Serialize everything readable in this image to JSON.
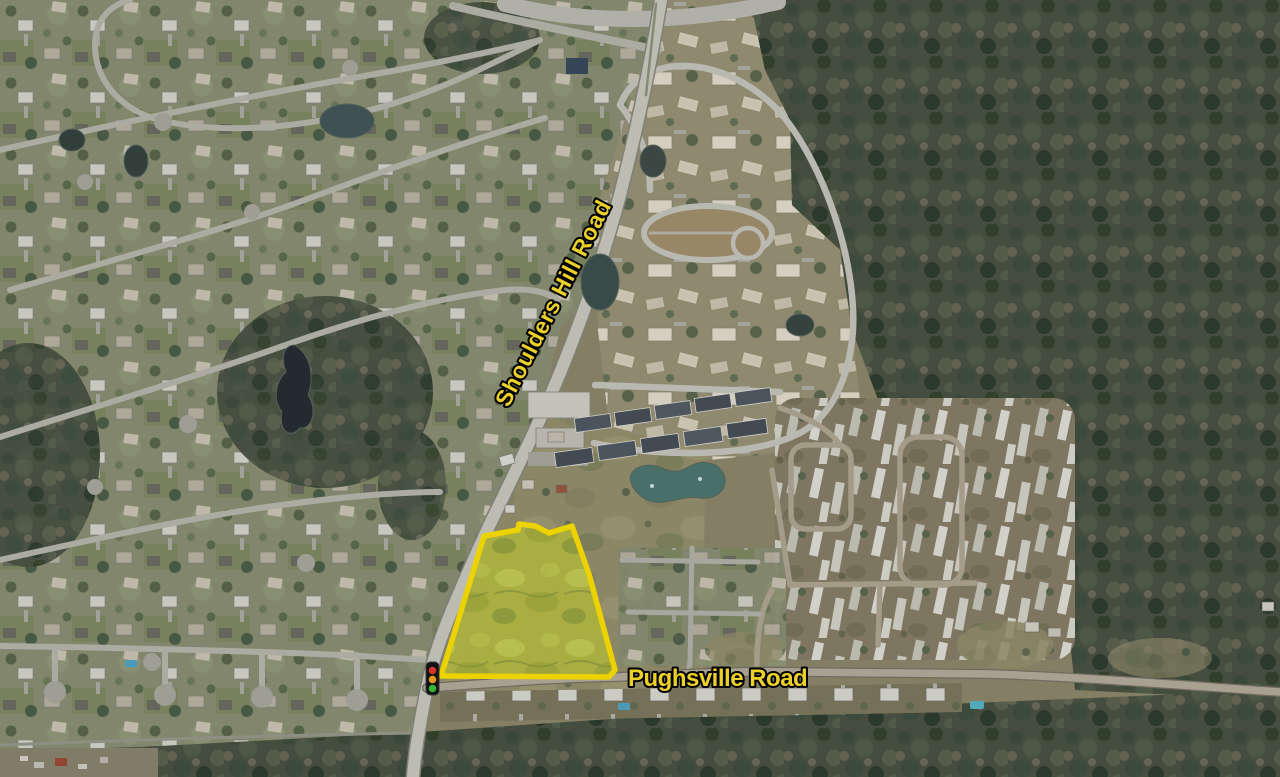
{
  "map": {
    "type": "aerial-photo",
    "labels": {
      "shoulders_hill_road": "Shoulders Hill Road",
      "pughsville_road": "Pughsville Road"
    },
    "label_style": {
      "fill": "#FFE12E",
      "outline": "#000000"
    },
    "parcel": {
      "points": "484,536 518,530 519,524 535,526 549,533 572,526 589,574 615,670 609,677 441,676 477,559",
      "stroke_color": "#FFE400",
      "fill_color": "#B9BE46"
    },
    "traffic_light": {
      "red": "#E03A2F",
      "amber": "#F5A623",
      "green": "#3DC53D"
    }
  }
}
